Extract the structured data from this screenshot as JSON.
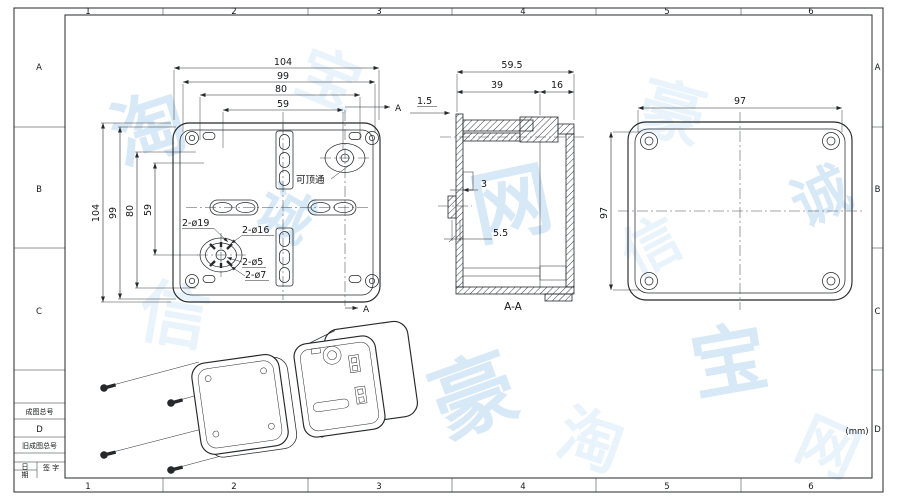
{
  "sheet": {
    "zone_columns": [
      "1",
      "2",
      "3",
      "4",
      "5",
      "6"
    ],
    "zone_rows": [
      "A",
      "B",
      "C",
      "D"
    ],
    "units_note": "(mm)"
  },
  "title_block": {
    "final_drawing_no_label": "成图总号",
    "final_drawing_no_value": "D",
    "old_drawing_no_label": "旧成图总号",
    "date_label_char1": "日",
    "date_label_char2": "期",
    "signature_label": "签 字"
  },
  "front_view": {
    "dim_width_overall": "104",
    "dim_width_screws": "99",
    "dim_width_inner": "80",
    "dim_width_slots": "59",
    "dim_height_overall": "104",
    "dim_height_screws": "99",
    "dim_height_inner": "80",
    "dim_height_slots": "59",
    "knockout_note": "可顶通",
    "hole_callout_1": "2-ø19",
    "hole_callout_2": "2-ø16",
    "hole_callout_3": "2-ø5",
    "hole_callout_4": "2-ø7",
    "section_arrow_label": "A"
  },
  "section_view": {
    "dim_depth_overall": "59.5",
    "dim_depth_body": "39",
    "dim_depth_lid": "16",
    "dim_wall": "1.5",
    "dim_step": "3",
    "dim_clip": "5.5",
    "view_label": "A-A"
  },
  "back_view": {
    "dim_width": "97",
    "dim_height": "97"
  },
  "watermark": {
    "glyphs": [
      "淘",
      "宝",
      "网",
      "豪",
      "诚",
      "信"
    ]
  }
}
